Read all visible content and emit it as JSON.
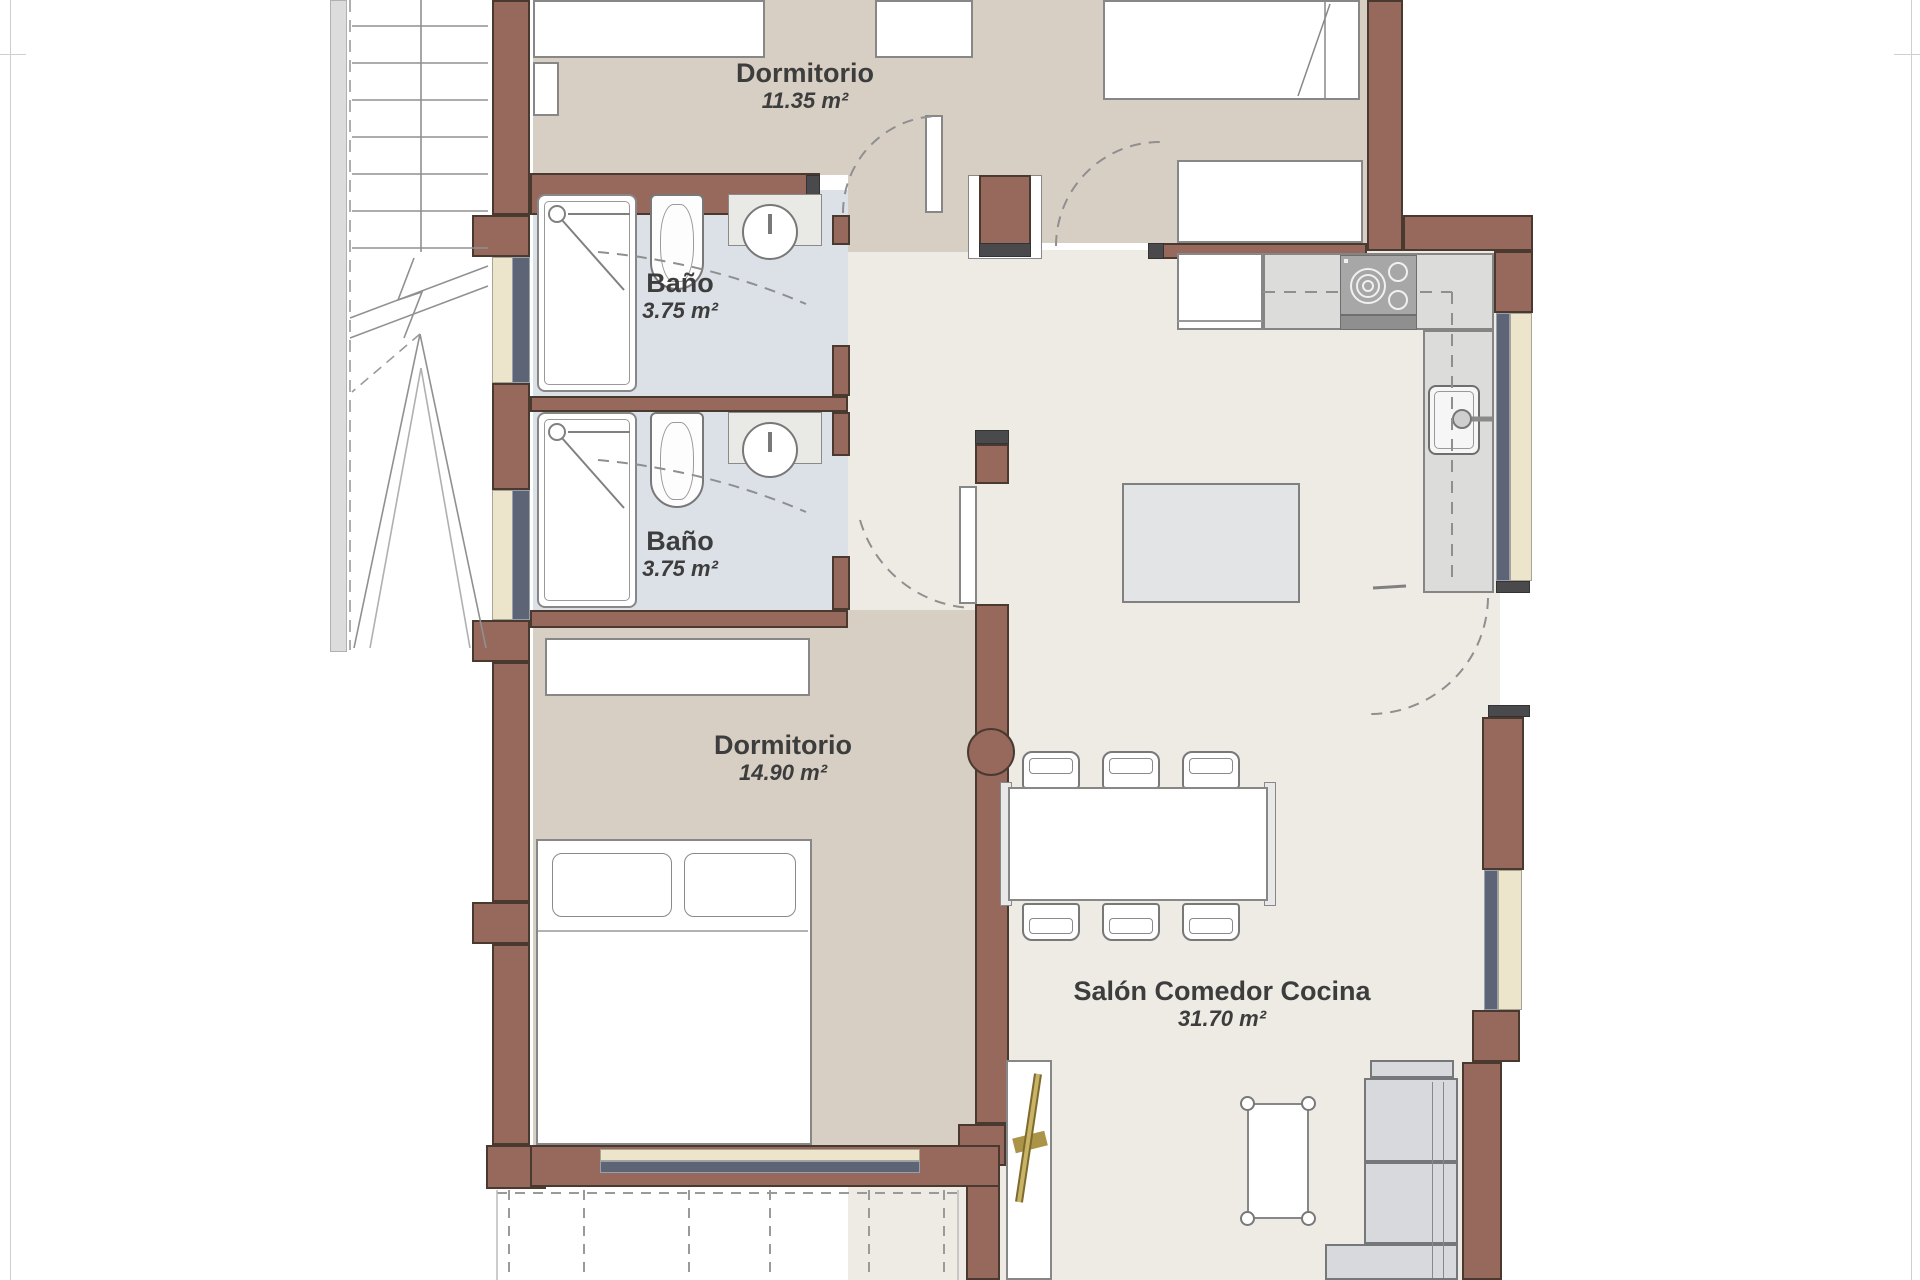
{
  "document": {
    "type": "architectural-floor-plan",
    "language": "es"
  },
  "palette": {
    "wall_fill": "#96695c",
    "wall_outline": "#4a392f",
    "wall_end_cap": "#4a4a4c",
    "floor_bedroom_hall": "#d8cfc4",
    "floor_living_kitchen": "#edebe4",
    "floor_bathroom": "#dce1e8",
    "window_glass": "#5c6476",
    "window_sill": "#ece5cc",
    "fixture_outline": "#787878",
    "label_text": "#3d3d3d",
    "door_handle_brass": "#ab9348"
  },
  "rooms": [
    {
      "id": "dormitorio-1",
      "name": "Dormitorio",
      "area": "11.35 m²"
    },
    {
      "id": "bano-1",
      "name": "Baño",
      "area": "3.75 m²"
    },
    {
      "id": "bano-2",
      "name": "Baño",
      "area": "3.75 m²"
    },
    {
      "id": "dormitorio-2",
      "name": "Dormitorio",
      "area": "14.90 m²"
    },
    {
      "id": "salon-comedor-cocina",
      "name": "Salón Comedor Cocina",
      "area": "31.70 m²"
    }
  ]
}
